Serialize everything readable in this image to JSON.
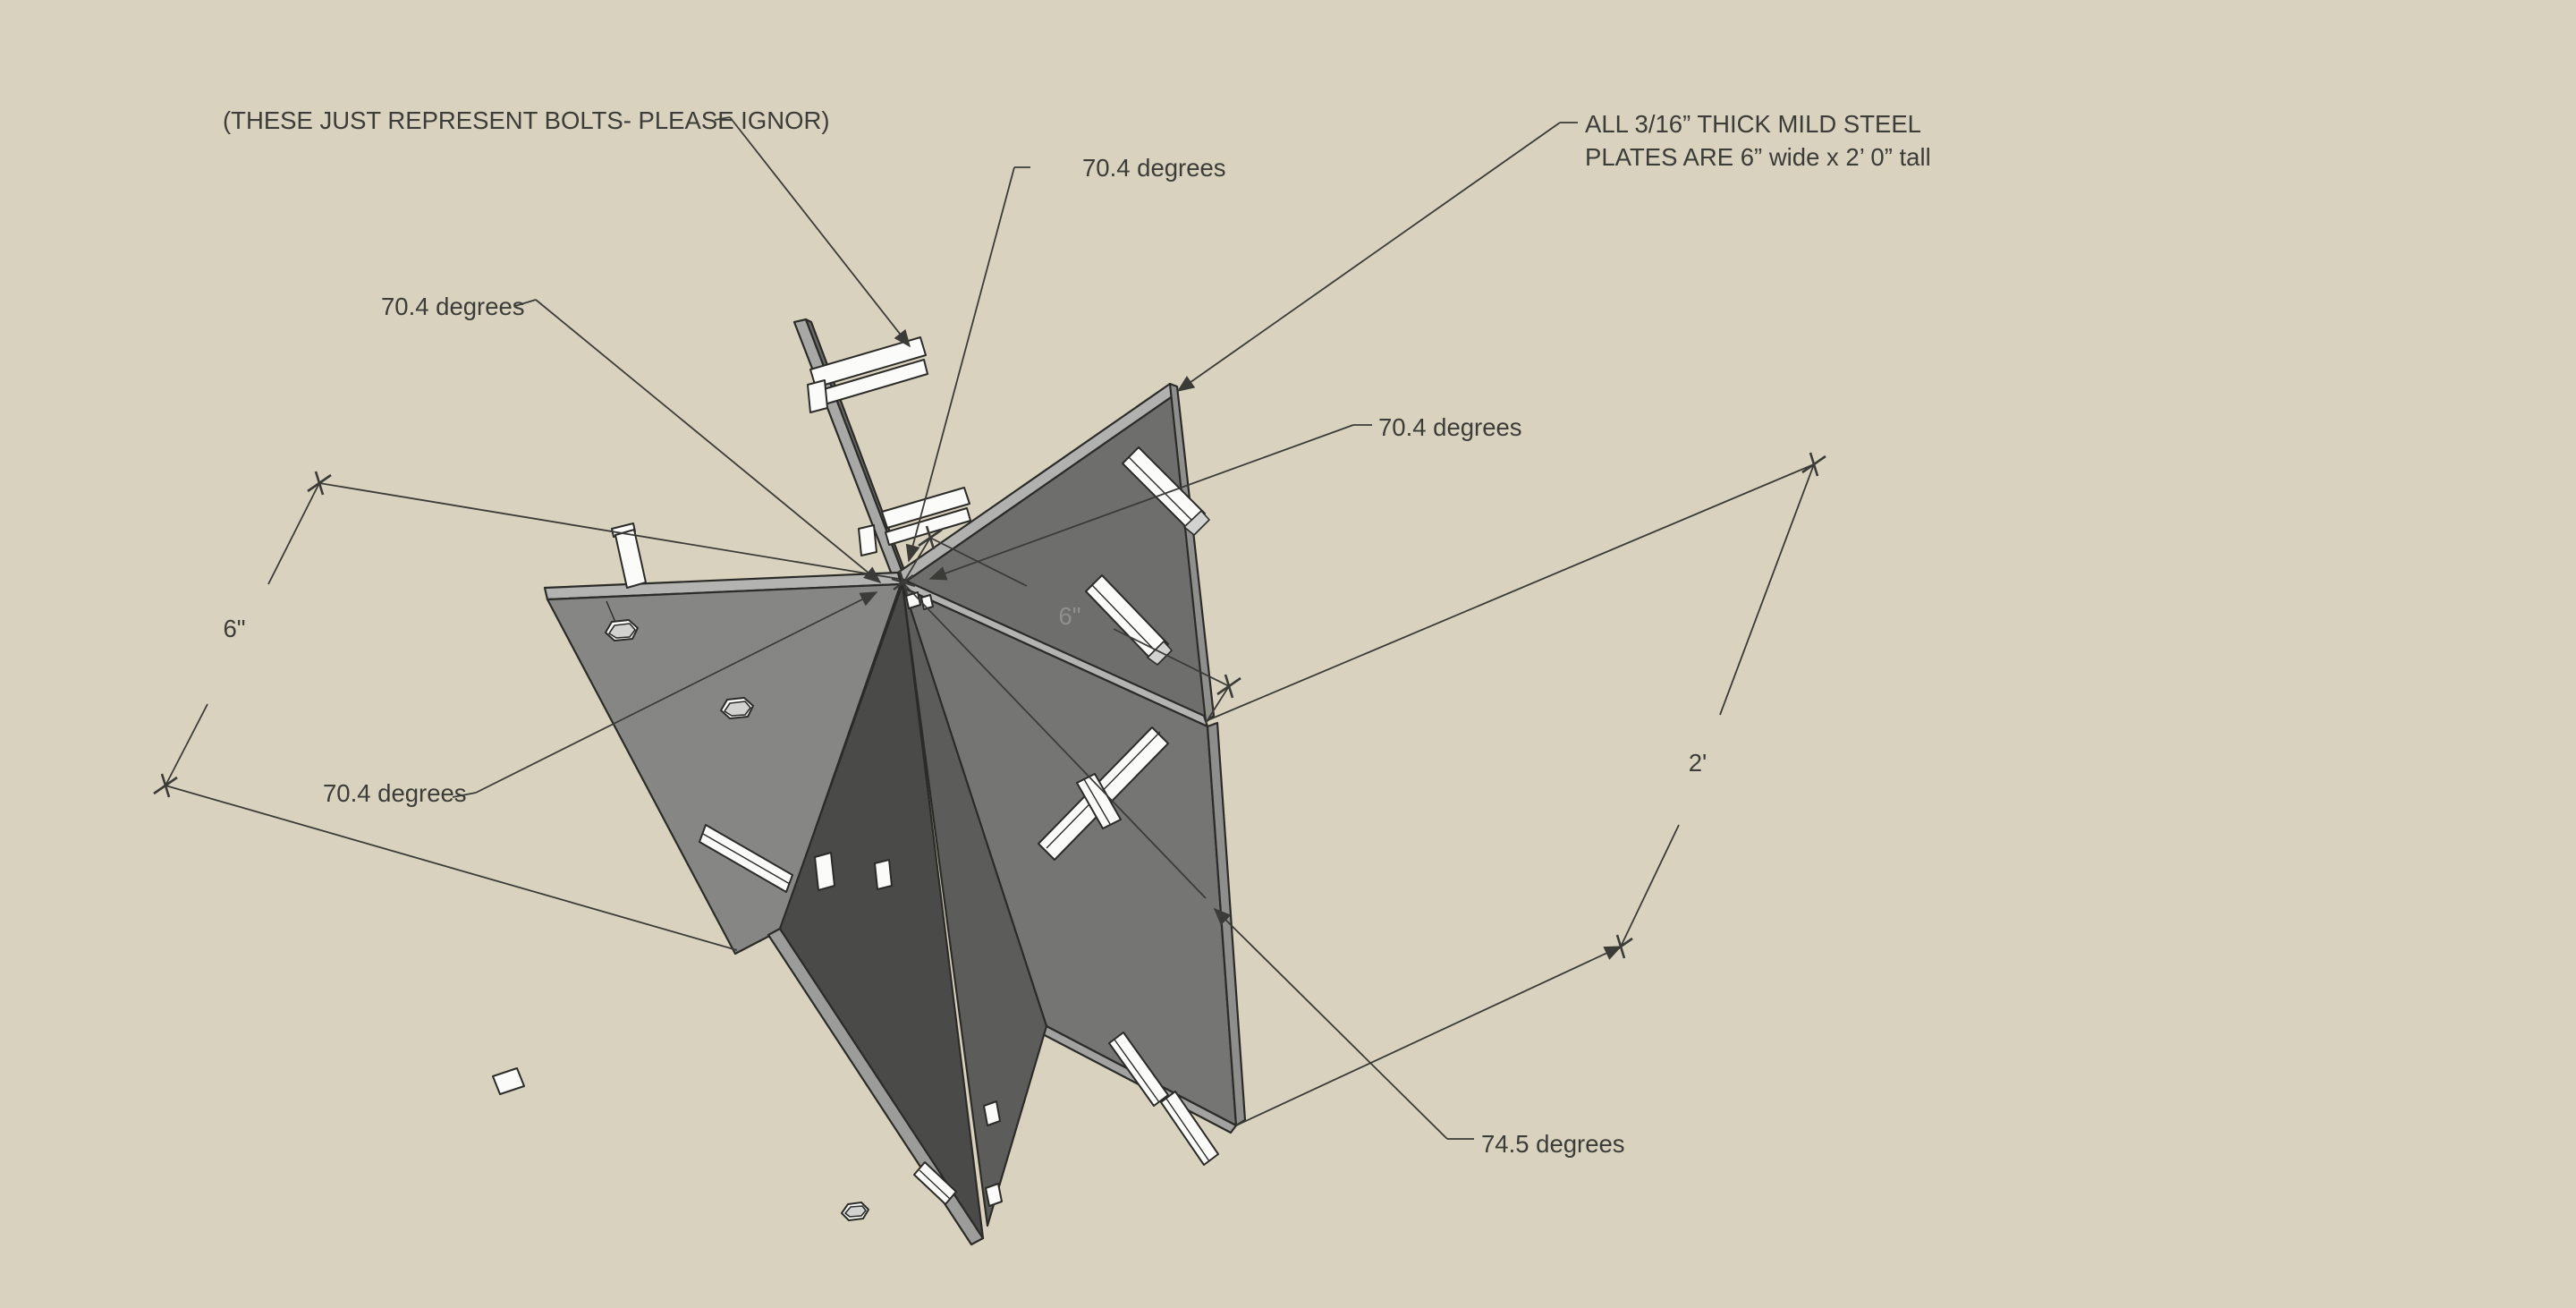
{
  "viewport": {
    "description_note": "(THESE JUST REPRESENT BOLTS- PLEASE IGNOR)"
  },
  "annotations": {
    "bolts_note": "(THESE JUST REPRESENT BOLTS- PLEASE IGNOR)",
    "spec_line1": "ALL 3/16” THICK MILD STEEL",
    "spec_line2": "PLATES ARE 6” wide x 2’ 0” tall",
    "angle_top": "70.4 degrees",
    "angle_upper_left": "70.4 degrees",
    "angle_lower_left": "70.4 degrees",
    "angle_right": "70.4 degrees",
    "angle_bottom_right": "74.5 degrees",
    "dim_left_width": "6\"",
    "dim_center_width": "6\"",
    "dim_right_height": "2'"
  },
  "colors": {
    "background": "#d9d2bf",
    "line": "#3b3b37",
    "text": "#3c3c38",
    "dim_text_on_plate": "#90908b",
    "plate_face_left": "#868685",
    "plate_face_upper_right": "#6e6e6c",
    "plate_face_lower_right": "#757573",
    "plate_face_middle": "#5c5c5a",
    "plate_face_front": "#4a4a48",
    "plate_edge_top": "#b2b2b0",
    "plate_edge_side": "#9b9b99",
    "bolt_fill": "#fbfbf9"
  }
}
